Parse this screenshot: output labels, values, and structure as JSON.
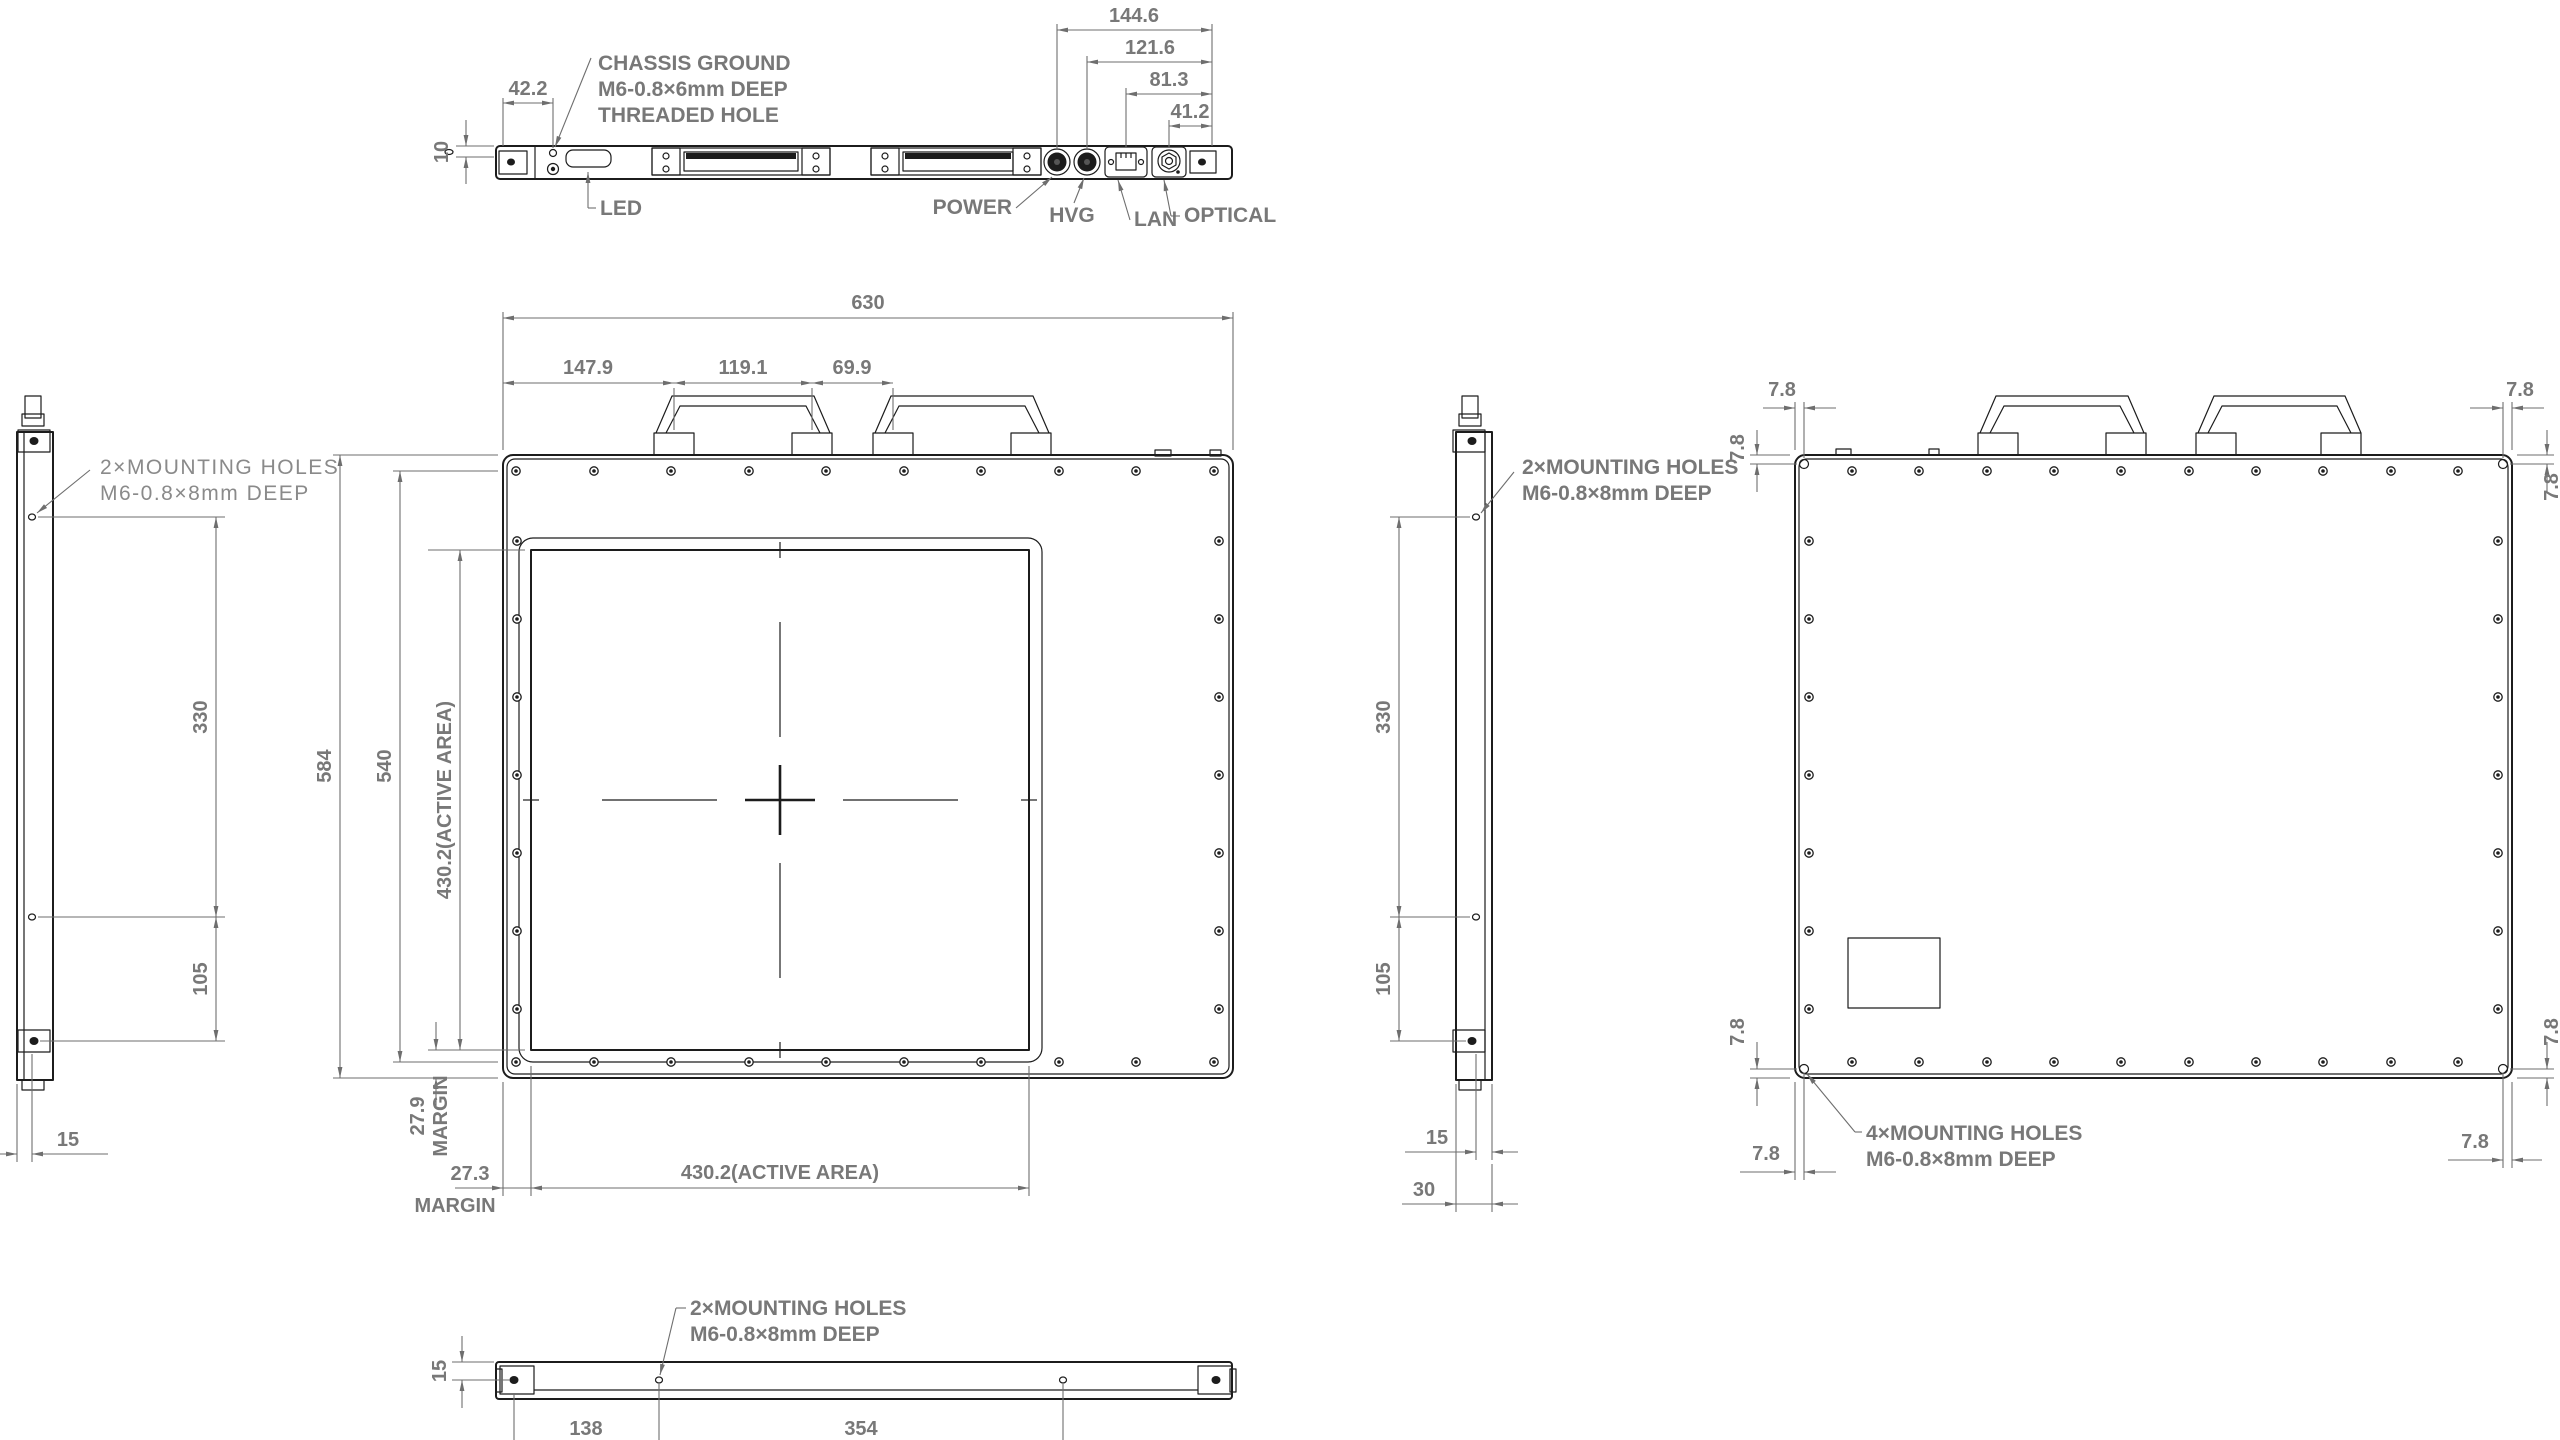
{
  "drawing_type": "technical-dimension-drawing",
  "colors": {
    "line": "#1c1c1c",
    "dim_line": "#6e6e6e",
    "text": "#787878",
    "background": "#ffffff"
  },
  "top_view": {
    "chassis_note_l1": "CHASSIS GROUND",
    "chassis_note_l2": "M6-0.8×6mm DEEP",
    "chassis_note_l3": "THREADED HOLE",
    "led": "LED",
    "power": "POWER",
    "hvg": "HVG",
    "lan": "LAN",
    "optical": "OPTICAL",
    "d_42_2": "42.2",
    "d_10": "10",
    "d_144_6": "144.6",
    "d_121_6": "121.6",
    "d_81_3": "81.3",
    "d_41_2": "41.2"
  },
  "front_view": {
    "d_630": "630",
    "d_147_9": "147.9",
    "d_119_1": "119.1",
    "d_69_9": "69.9",
    "d_584": "584",
    "d_540": "540",
    "d_active": "430.2(ACTIVE AREA)",
    "d_27_9": "27.9",
    "d_27_3": "27.3",
    "margin": "MARGIN"
  },
  "left_view": {
    "note_l1": "2×MOUNTING HOLES",
    "note_l2": "M6-0.8×8mm DEEP",
    "d_330": "330",
    "d_105": "105",
    "d_15": "15"
  },
  "right_view": {
    "note_l1": "2×MOUNTING HOLES",
    "note_l2": "M6-0.8×8mm DEEP",
    "d_330": "330",
    "d_105": "105",
    "d_15": "15",
    "d_30": "30"
  },
  "rear_view": {
    "note_l1": "4×MOUNTING HOLES",
    "note_l2": "M6-0.8×8mm DEEP",
    "d_7_8": "7.8"
  },
  "bottom_view": {
    "note_l1": "2×MOUNTING HOLES",
    "note_l2": "M6-0.8×8mm DEEP",
    "d_15": "15",
    "d_138": "138",
    "d_354": "354"
  }
}
